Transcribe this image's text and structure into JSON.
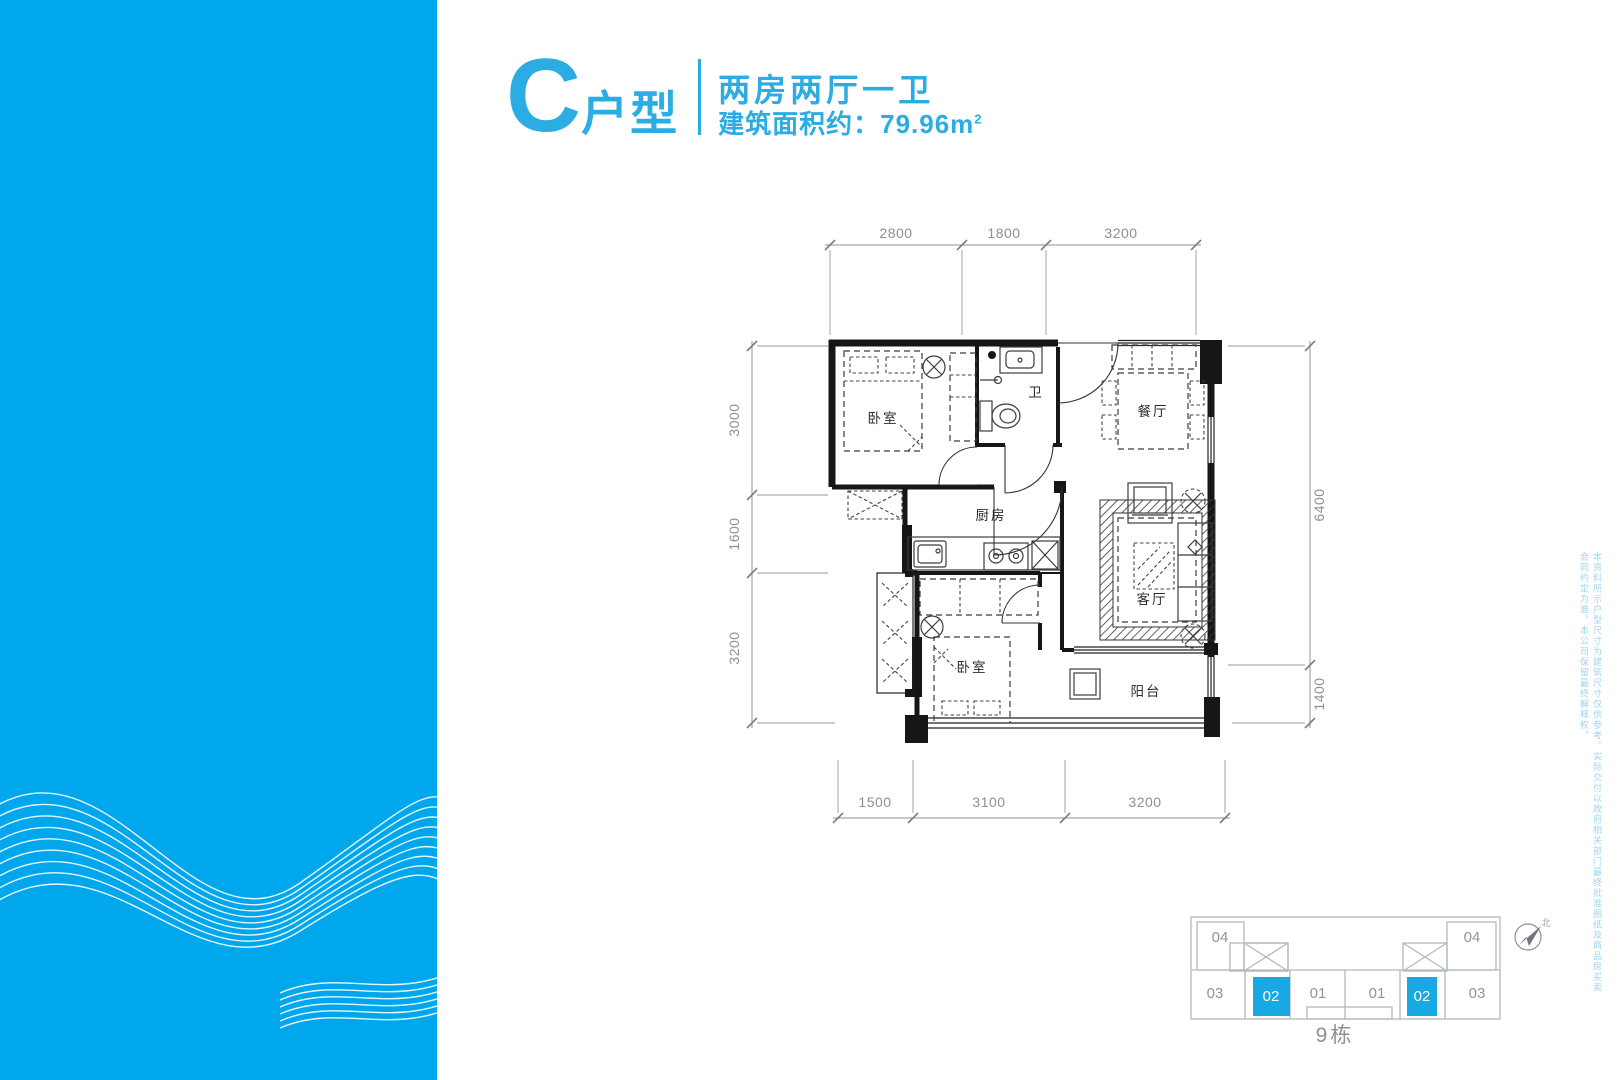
{
  "title": {
    "unit": "C",
    "unit_suffix": "户型",
    "layout": "两房两厅一卫",
    "area_label": "建筑面积约：79.96m",
    "area_sup": "2"
  },
  "plan": {
    "rooms": [
      "卧室",
      "卫",
      "餐厅",
      "厨房",
      "客厅",
      "卧室",
      "阳台"
    ],
    "dims": {
      "top": [
        "2800",
        "1800",
        "3200"
      ],
      "left": [
        "3000",
        "1600",
        "3200"
      ],
      "right": [
        "6400",
        "1400"
      ],
      "bottom": [
        "1500",
        "3100",
        "3200"
      ]
    }
  },
  "keyplan": {
    "units": [
      "04",
      "03",
      "02",
      "01",
      "01",
      "02",
      "03",
      "04"
    ],
    "building": "9栋",
    "north": "北",
    "highlight_color": "#18a8e2"
  },
  "band_color": "#00a7ec",
  "accent_color": "#2bace2",
  "disclaimer": "本资料所示户型尺寸为建筑尺寸仅供参考，实际交付以政府相关部门最终批准图纸及商品房买卖合同约定为准，本公司保留最终解释权。"
}
